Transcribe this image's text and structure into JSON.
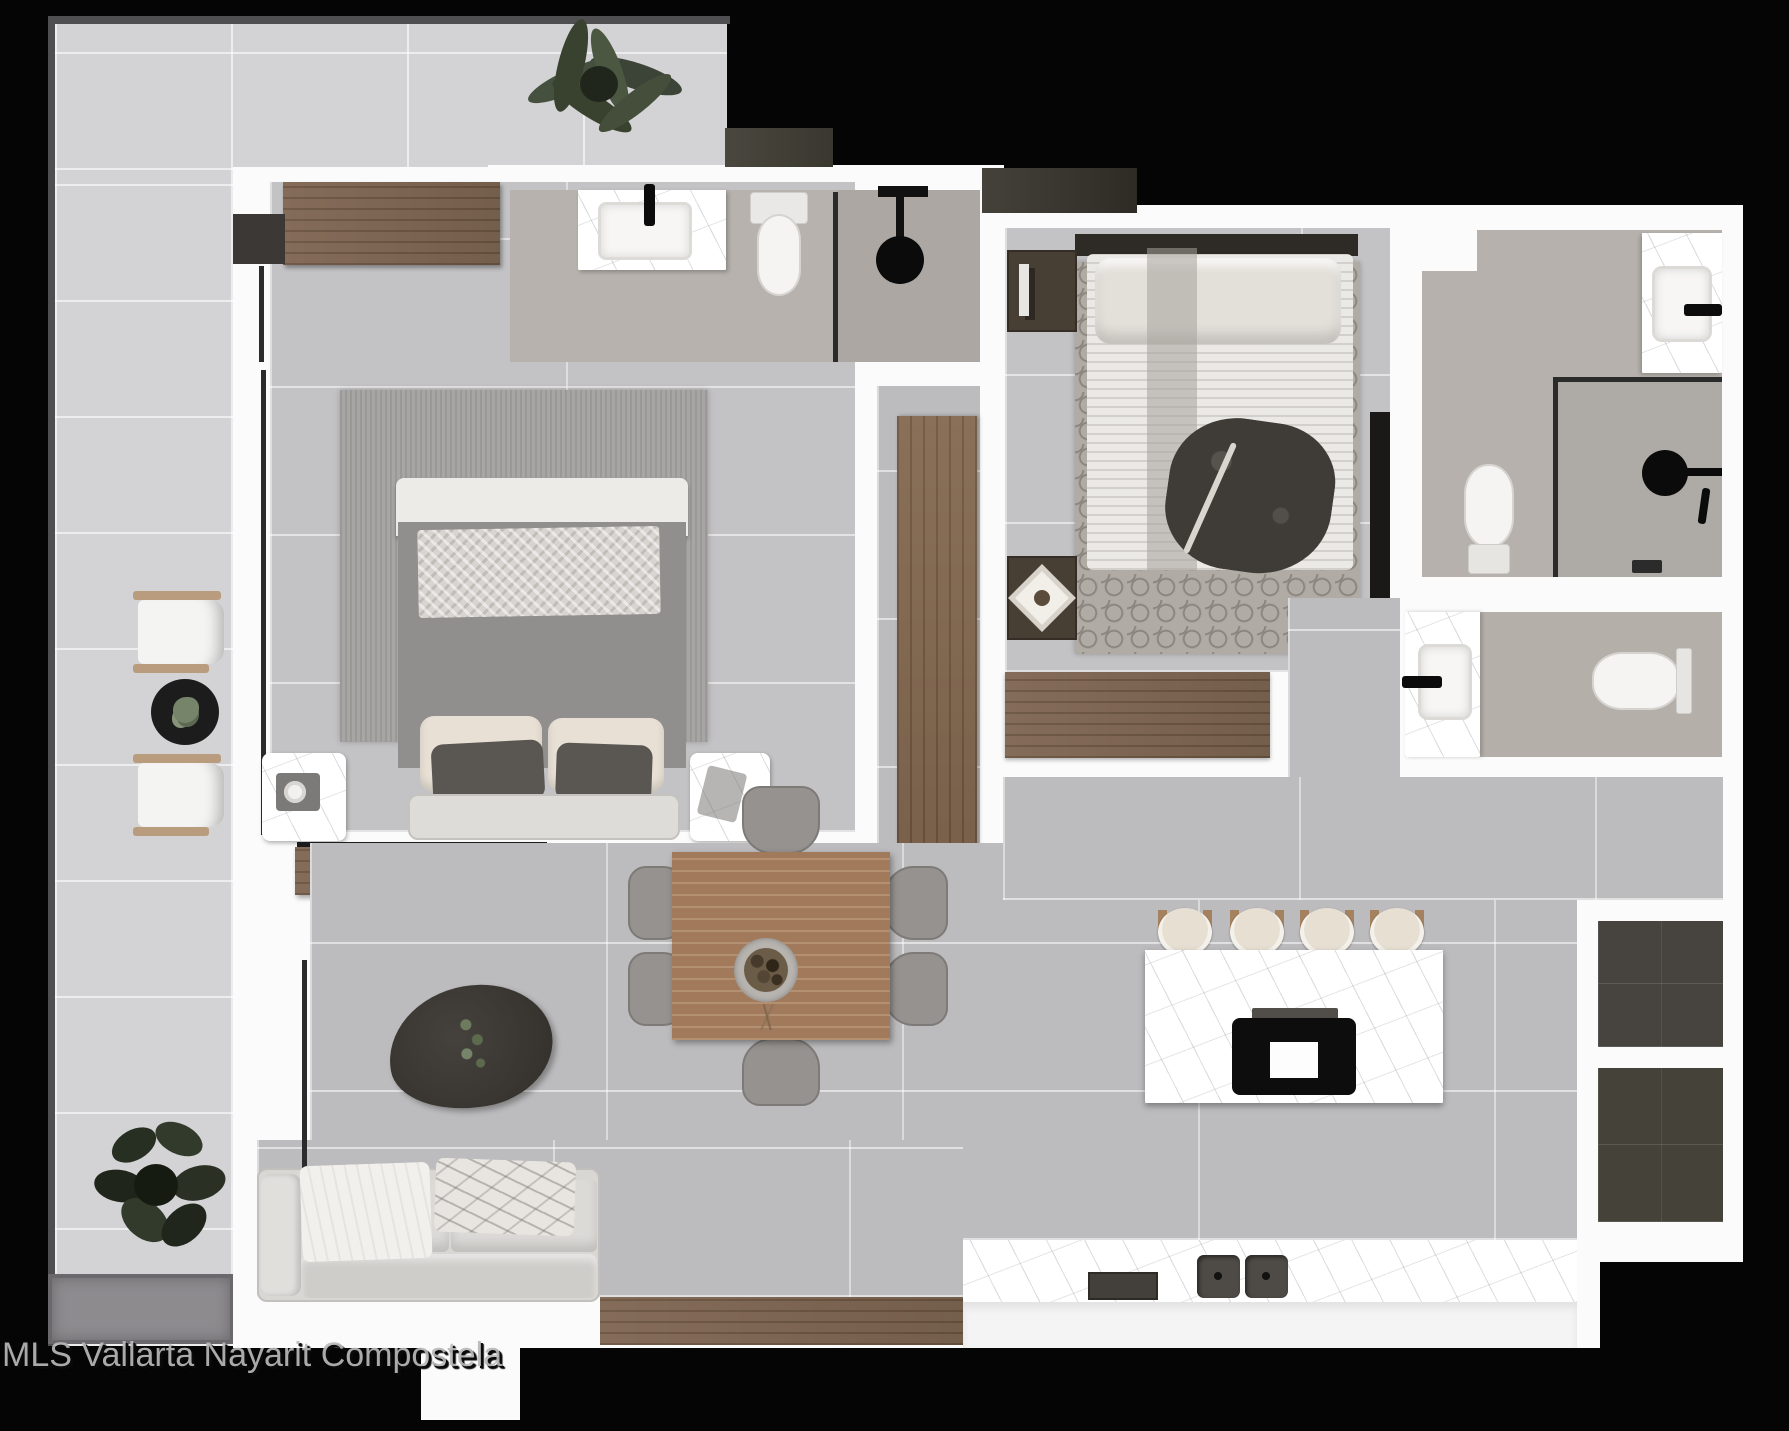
{
  "watermark": {
    "text": "MLS Vallarta Nayarit Compostela"
  },
  "image_type": "rendered-floor-plan-top-view",
  "palette": {
    "background": "#050505",
    "walls": "#fbfbfb",
    "terrace_tile": "#d3d3d5",
    "room_tile": "#c3c2c4",
    "bathroom_floor": "#b7b2ad",
    "wood": "#77604a",
    "dark_wood": "#473e34",
    "marble": "#ffffff",
    "dark_patio": "#474440",
    "fixtures_black": "#0c0c0c"
  },
  "rooms": [
    {
      "id": "terrace",
      "name": "wrap-around terrace",
      "items": [
        "palm-plant",
        "lounge-chair",
        "lounge-chair",
        "round-side-table",
        "leafy-plant",
        "planter-box"
      ]
    },
    {
      "id": "master-bedroom",
      "name": "master bedroom",
      "items": [
        "wardrobe",
        "double-bed",
        "area-rug",
        "marble-side-table",
        "marble-side-table",
        "console-shelf"
      ]
    },
    {
      "id": "ensuite-bathroom",
      "name": "en-suite bathroom",
      "items": [
        "vanity-sink",
        "toilet",
        "walk-in-shower"
      ]
    },
    {
      "id": "bedroom-2",
      "name": "second bedroom",
      "items": [
        "double-bed",
        "patterned-rug",
        "nightstand",
        "dresser",
        "tv-panel",
        "closet"
      ]
    },
    {
      "id": "bathroom-2",
      "name": "main bathroom",
      "items": [
        "vanity-sink",
        "toilet",
        "walk-in-shower"
      ]
    },
    {
      "id": "bathroom-3",
      "name": "guest bathroom",
      "items": [
        "vanity-sink",
        "toilet"
      ]
    },
    {
      "id": "great-room",
      "name": "open living / dining / kitchen",
      "items": [
        "sofa",
        "coffee-table",
        "dining-table",
        "dining-chairs-x6",
        "kitchen-island",
        "bar-stools-x4",
        "cooktop",
        "kitchen-counter",
        "double-sink"
      ]
    },
    {
      "id": "service-patio",
      "name": "service patio",
      "items": [
        "dark-tile-square",
        "dark-tile-square"
      ]
    }
  ]
}
